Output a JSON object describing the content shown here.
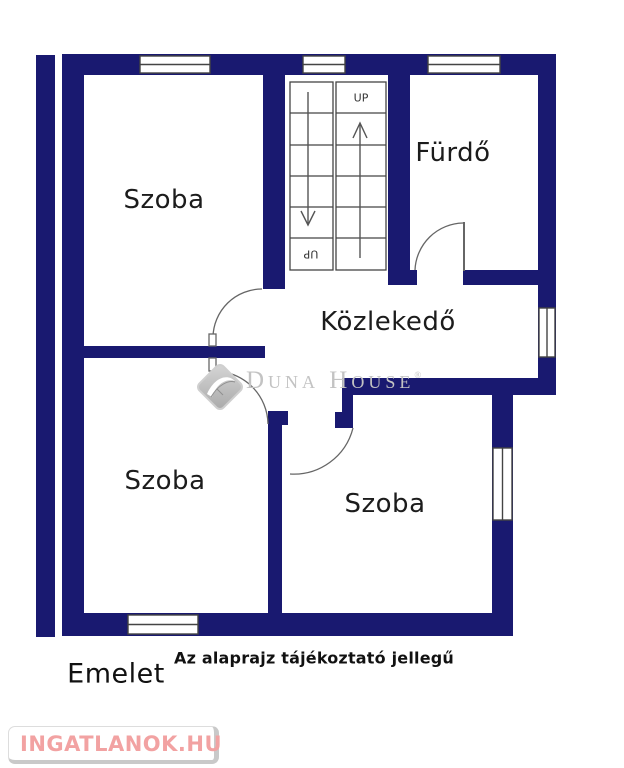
{
  "floorplan": {
    "rooms": [
      {
        "label": "Szoba",
        "position": "top-left"
      },
      {
        "label": "Fürdő",
        "position": "top-right"
      },
      {
        "label": "Közlekedő",
        "position": "center-hall"
      },
      {
        "label": "Szoba",
        "position": "bottom-left"
      },
      {
        "label": "Szoba",
        "position": "bottom-right"
      }
    ],
    "stairs": {
      "up_label": "UP",
      "down_flight_label": "UP"
    },
    "footer": {
      "floor_label": "Emelet",
      "disclaimer": "Az alaprajz tájékoztató jellegű"
    },
    "watermark": {
      "brand": "Duna House",
      "registered_mark": "®"
    },
    "site_logo": {
      "text": "INGATLANOK.HU"
    }
  },
  "colors": {
    "wall": "#191970",
    "outline": "#444444",
    "door": "#666666",
    "watermark": "#c3c3c3",
    "logo_pink": "#f2a2a2"
  }
}
